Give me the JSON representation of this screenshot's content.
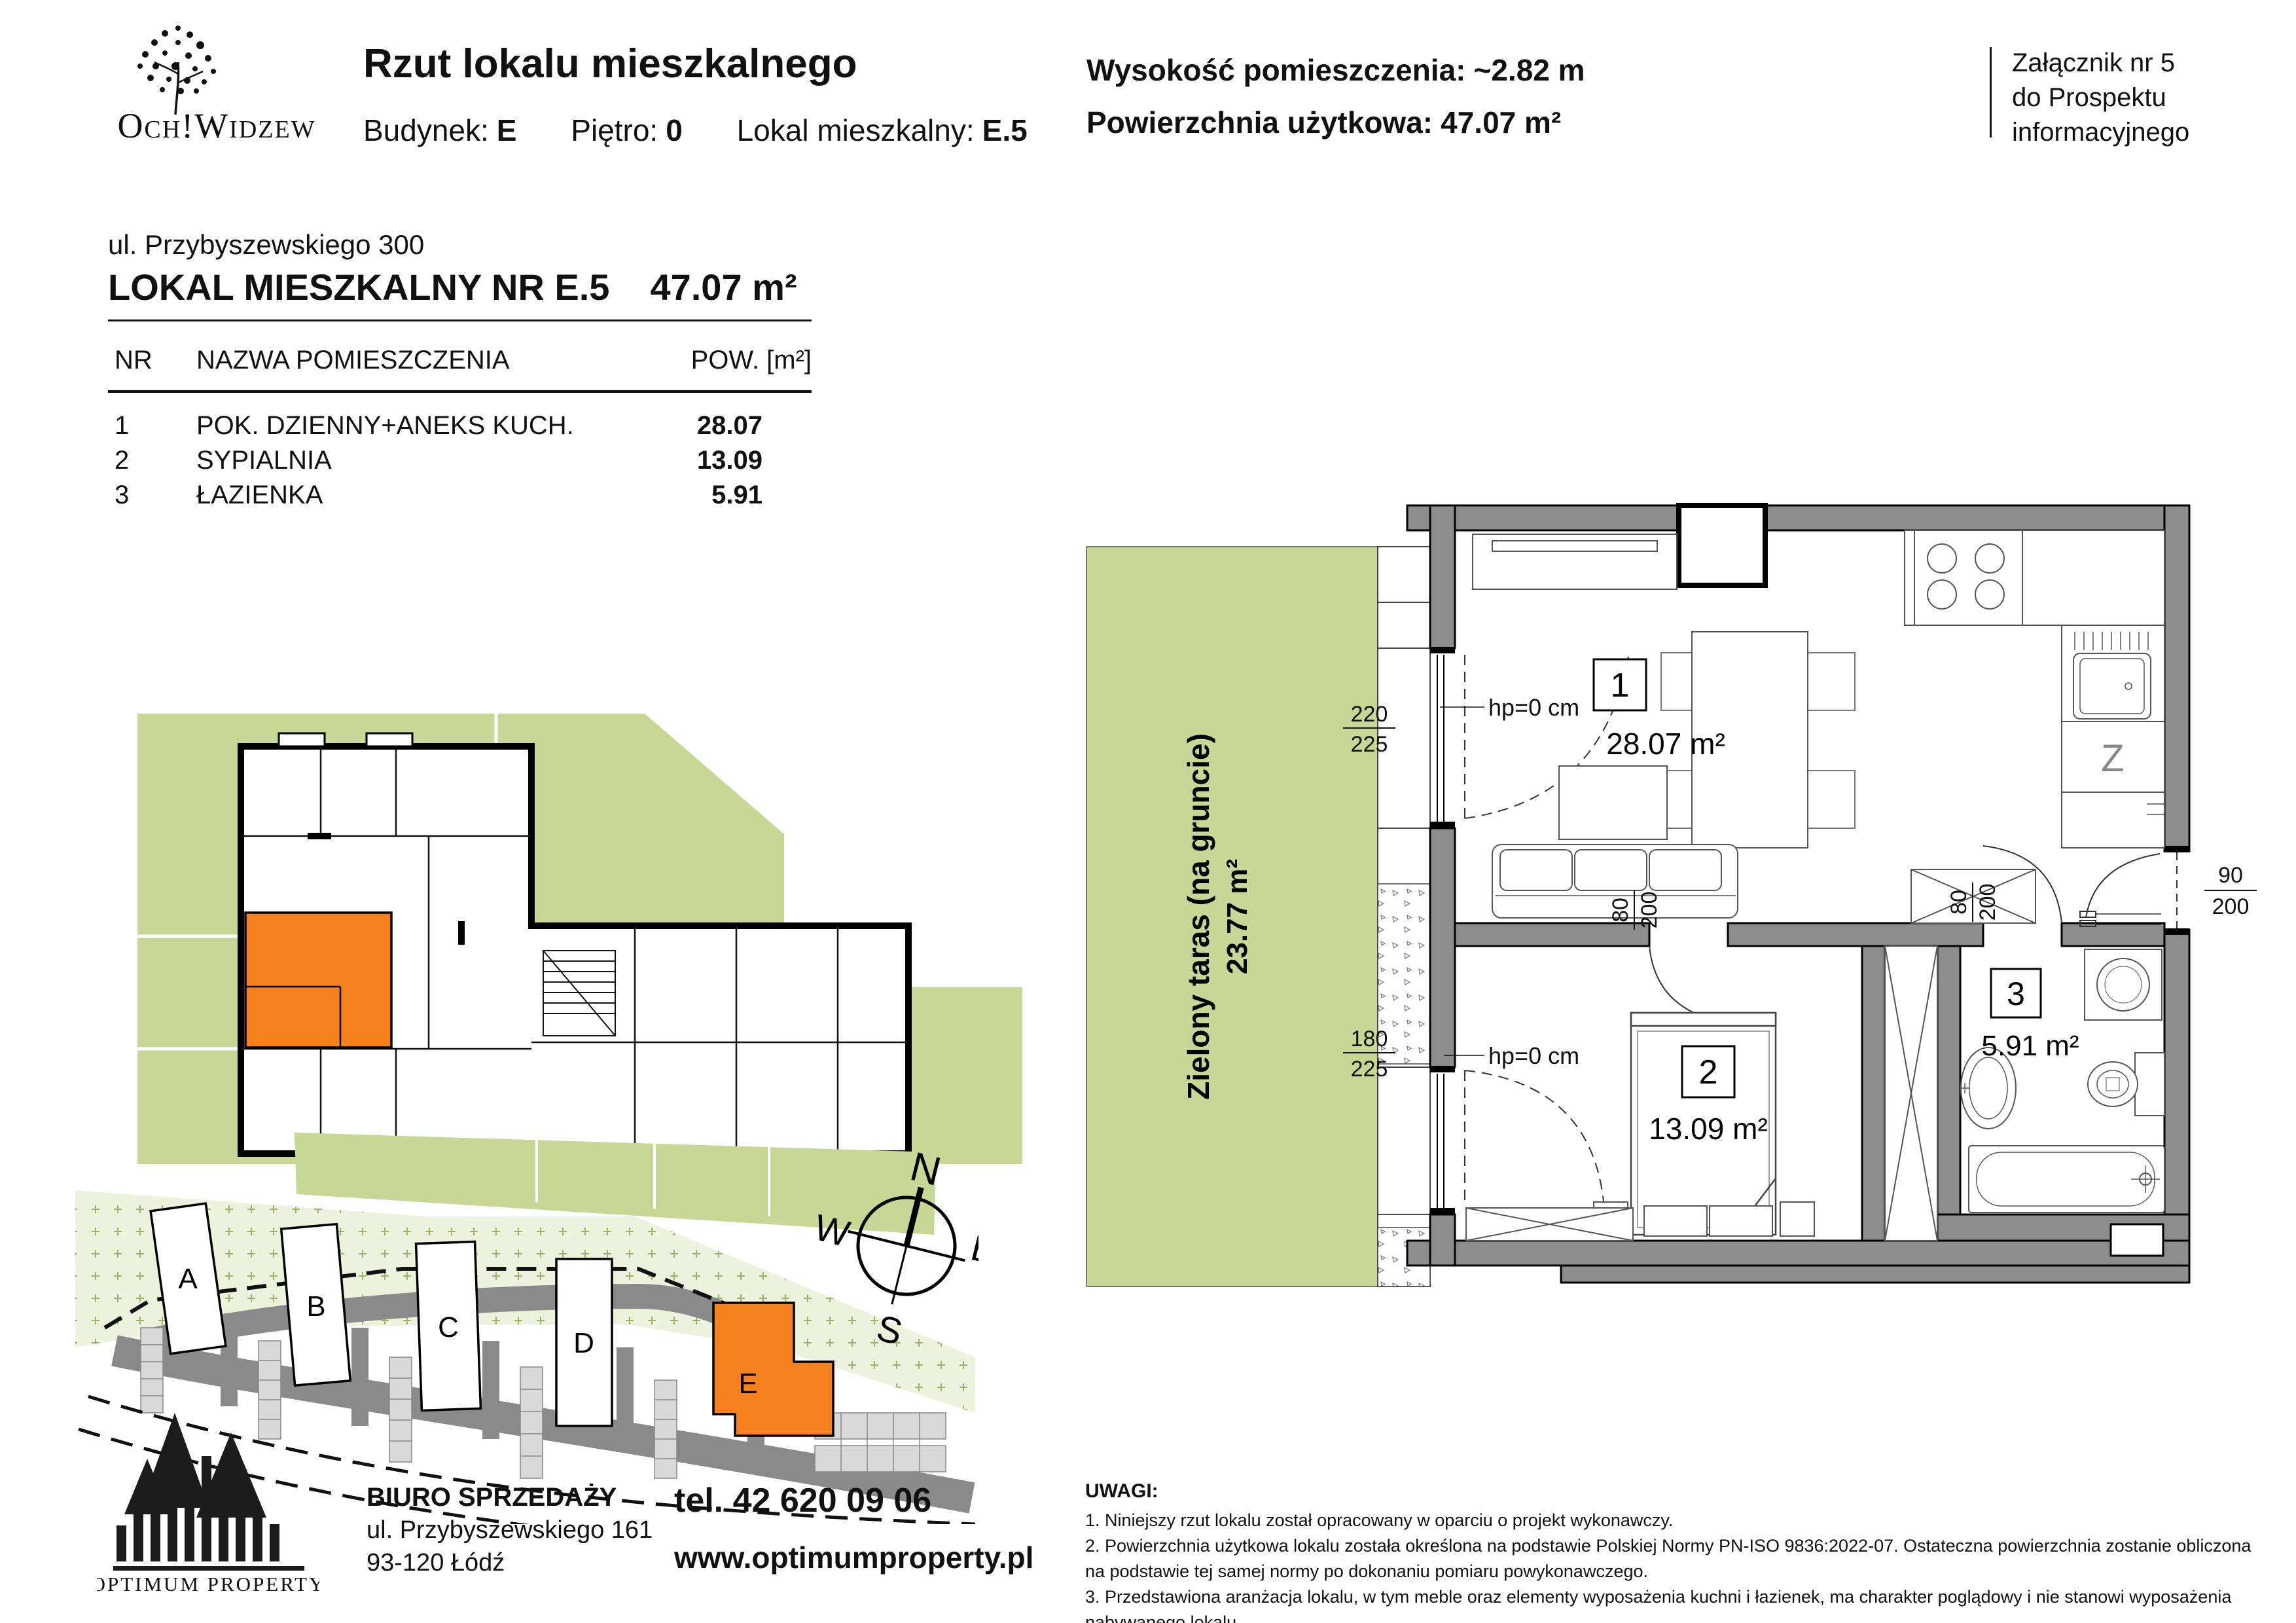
{
  "header": {
    "logo_text": "Och!Widzew",
    "title": "Rzut lokalu mieszkalnego",
    "building_label": "Budynek:",
    "building_value": "E",
    "floor_label": "Piętro:",
    "floor_value": "0",
    "unit_label": "Lokal mieszkalny:",
    "unit_value": "E.5",
    "height_label": "Wysokość pomieszczenia:",
    "height_value": "~2.82 m",
    "area_label": "Powierzchnia użytkowa:",
    "area_value": "47.07 m²",
    "attachment_line1": "Załącznik nr 5",
    "attachment_line2": "do Prospektu",
    "attachment_line3": "informacyjnego"
  },
  "unit_info": {
    "address": "ul. Przybyszewskiego 300",
    "title": "LOKAL MIESZKALNY NR E.5",
    "title_area": "47.07 m²",
    "col_nr": "NR",
    "col_name": "NAZWA POMIESZCZENIA",
    "col_area": "POW. [m²]",
    "rows": [
      {
        "nr": "1",
        "name": "POK. DZIENNY+ANEKS KUCH.",
        "area": "28.07"
      },
      {
        "nr": "2",
        "name": "SYPIALNIA",
        "area": "13.09"
      },
      {
        "nr": "3",
        "name": "ŁAZIENKA",
        "area": "5.91"
      }
    ]
  },
  "location_plan": {
    "caption_line1": "Usytuowanie lokalu",
    "caption_line2": "miszkalnego w budynku"
  },
  "site_plan": {
    "buildings": [
      "A",
      "B",
      "C",
      "D",
      "E"
    ],
    "compass": {
      "n": "N",
      "e": "E",
      "s": "S",
      "w": "W"
    }
  },
  "floor_plan": {
    "terrace_line1": "Zielony taras (na gruncie)",
    "terrace_line2": "23.77 m²",
    "room1_nr": "1",
    "room1_area": "28.07 m²",
    "room2_nr": "2",
    "room2_area": "13.09 m²",
    "room3_nr": "3",
    "room3_area": "5.91 m²",
    "dim_win_top": {
      "top": "220",
      "bottom": "225"
    },
    "dim_win_bottom": {
      "top": "180",
      "bottom": "225"
    },
    "dim_entry": {
      "top": "90",
      "bottom": "200"
    },
    "dim_door_bedroom": {
      "top": "80",
      "bottom": "200"
    },
    "dim_door_bath": {
      "top": "80",
      "bottom": "200"
    },
    "hp_top": "hp=0 cm",
    "hp_bottom": "hp=0 cm",
    "kitchen_label": "Z"
  },
  "footer": {
    "logo_text": "OPTIMUM PROPERTY",
    "office_label": "BIURO SPRZEDAŻY",
    "office_address1": "ul. Przybyszewskiego 161",
    "office_address2": "93-120 Łódź",
    "phone": "tel. 42 620 09 06",
    "website": "www.optimumproperty.pl"
  },
  "notes": {
    "title": "UWAGI:",
    "item1": "1. Niniejszy rzut lokalu został opracowany w oparciu o projekt wykonawczy.",
    "item2": "2. Powierzchnia użytkowa lokalu została określona na podstawie Polskiej Normy PN-ISO 9836:2022-07.  Ostateczna powierzchnia zostanie obliczona na podstawie tej samej normy po dokonaniu pomiaru powykonawczego.",
    "item3": "3. Przedstawiona aranżacja lokalu, w tym meble oraz elementy wyposażenia kuchni i łazienek, ma charakter poglądowy i nie stanowi wyposażenia nabywanego lokalu."
  },
  "colors": {
    "accent_orange": "#f5821f",
    "green": "#c7d795",
    "wall_gray": "#8d8d8d"
  }
}
